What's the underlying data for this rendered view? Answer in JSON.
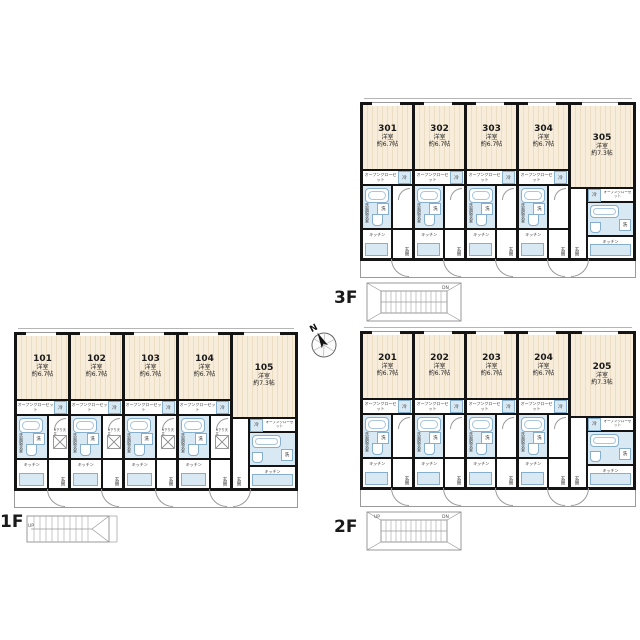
{
  "compass": {
    "north_label": "N"
  },
  "stairs": {
    "up_label": "UP",
    "down_label": "DN"
  },
  "unit_labels": {
    "closet": "オープンクローゼット",
    "fridge": "冷",
    "washroom": "洗面脱衣室",
    "washer": "洗",
    "kitchen": "キッチン",
    "entrance": "玄関",
    "ceiling_note": "※下り天井"
  },
  "floors": [
    {
      "label": "3F",
      "has_note": false,
      "units": [
        {
          "no": "301",
          "room": "洋室",
          "size": "約6.7帖"
        },
        {
          "no": "302",
          "room": "洋室",
          "size": "約6.7帖"
        },
        {
          "no": "303",
          "room": "洋室",
          "size": "約6.7帖"
        },
        {
          "no": "304",
          "room": "洋室",
          "size": "約6.7帖"
        },
        {
          "no": "305",
          "room": "洋室",
          "size": "約7.3帖",
          "wide": true
        }
      ]
    },
    {
      "label": "2F",
      "has_note": false,
      "units": [
        {
          "no": "201",
          "room": "洋室",
          "size": "約6.7帖"
        },
        {
          "no": "202",
          "room": "洋室",
          "size": "約6.7帖"
        },
        {
          "no": "203",
          "room": "洋室",
          "size": "約6.7帖"
        },
        {
          "no": "204",
          "room": "洋室",
          "size": "約6.7帖"
        },
        {
          "no": "205",
          "room": "洋室",
          "size": "約7.3帖",
          "wide": true
        }
      ]
    },
    {
      "label": "1F",
      "has_note": true,
      "units": [
        {
          "no": "101",
          "room": "洋室",
          "size": "約6.7帖"
        },
        {
          "no": "102",
          "room": "洋室",
          "size": "約6.7帖"
        },
        {
          "no": "103",
          "room": "洋室",
          "size": "約6.7帖"
        },
        {
          "no": "104",
          "room": "洋室",
          "size": "約6.7帖"
        },
        {
          "no": "105",
          "room": "洋室",
          "size": "約7.3帖",
          "wide": true
        }
      ]
    }
  ],
  "colors": {
    "wall": "#141414",
    "floor_fill": "#f8edda",
    "floor_stripe": "#ebdec5",
    "wet_fill": "#d8e9f4",
    "wet_line": "#86aecd",
    "thin_line": "#9a9a9a",
    "background": "#ffffff"
  }
}
